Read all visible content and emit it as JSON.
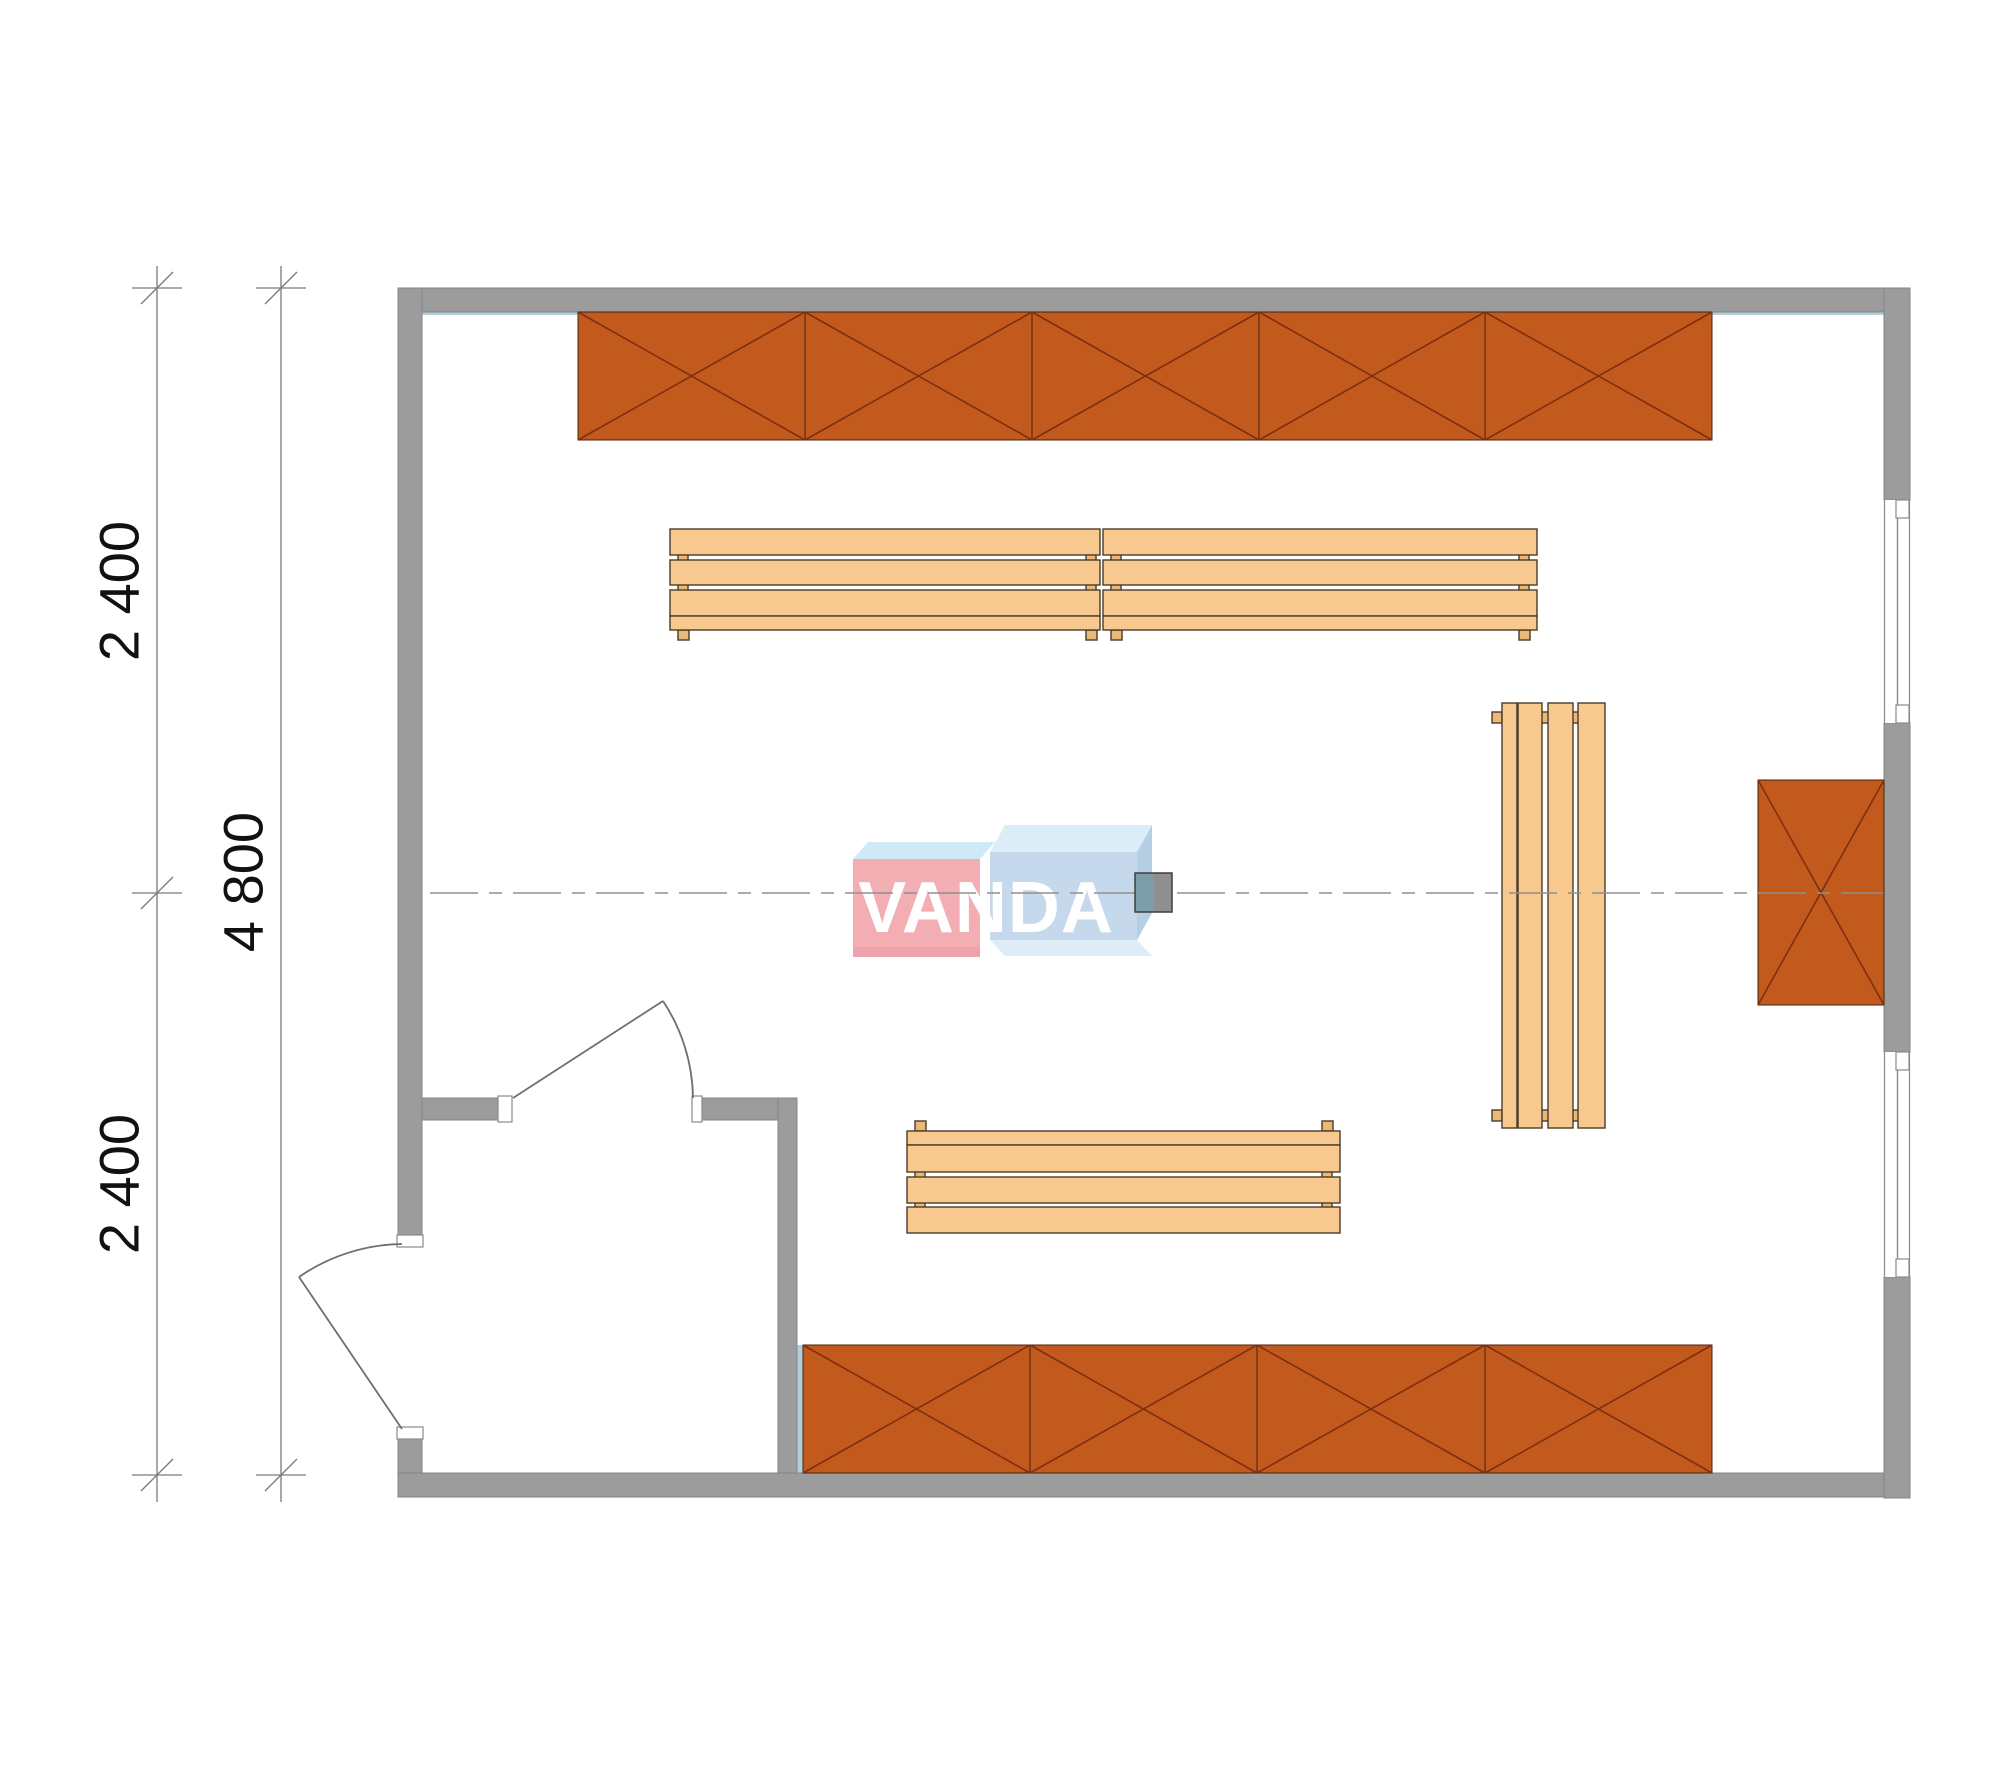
{
  "document": {
    "type": "architectural floor plan",
    "room": "sauna / cabin plan with benches, heater and wall cabinets"
  },
  "dimensions": {
    "left_segment_top": "2 400",
    "left_segment_bottom": "2 400",
    "left_total": "4 800"
  },
  "watermark": {
    "text": "VANDA"
  },
  "counts": {
    "top_cabinet_sections": 5,
    "bottom_cabinet_sections": 4,
    "right_cabinet_sections": 1,
    "benches": 4,
    "windows": 2,
    "doors": 2
  },
  "colors": {
    "wall": "#9c9c9c",
    "wall_edge": "#858585",
    "cabinet": "#c35a1d",
    "cabinet_line": "#7d2f10",
    "cabinet_edge": "#46230d",
    "bench": "#f7c98f",
    "bench_edge": "#4a3b28",
    "bench_foot": "#eab877",
    "accent_strip": "#b3cdd9",
    "stove_left": "#7e9daa",
    "stove_right": "#8f8f8f",
    "dim_line": "#7a7a7a",
    "dim_text": "#111111",
    "door_line": "#6f6f6f",
    "centerline": "#8f8f8f",
    "frame_line": "#8a8a8a",
    "logo_pink": "#f3aeb4",
    "logo_pink_dark": "#eda3ab",
    "logo_cyan": "#cdeaf5",
    "logo_blue": "#c6d9ec",
    "logo_blue_side": "#b5cfe4",
    "logo_pale": "#dcedf8",
    "logo_text": "#ffffff"
  }
}
